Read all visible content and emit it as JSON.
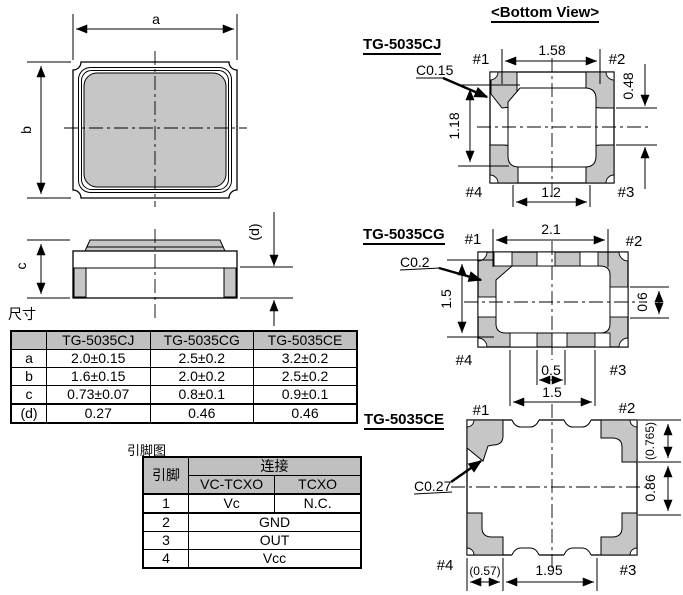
{
  "page": {
    "bottom_view_title": "<Bottom View>",
    "colors": {
      "line": "#000000",
      "pad_gray": "#c6c6c6",
      "table_header_bg": "#c0c0c0"
    }
  },
  "outline_view": {
    "dim_a": "a",
    "dim_b": "b",
    "dim_c": "c",
    "dim_d": "(d)"
  },
  "dimension_table": {
    "title": "尺寸",
    "columns": [
      "",
      "TG-5035CJ",
      "TG-5035CG",
      "TG-5035CE"
    ],
    "rows": [
      {
        "label": "a",
        "values": [
          "2.0±0.15",
          "2.5±0.2",
          "3.2±0.2"
        ]
      },
      {
        "label": "b",
        "values": [
          "1.6±0.15",
          "2.0±0.2",
          "2.5±0.2"
        ]
      },
      {
        "label": "c",
        "values": [
          "0.73±0.07",
          "0.8±0.1",
          "0.9±0.1"
        ]
      },
      {
        "label": "(d)",
        "values": [
          "0.27",
          "0.46",
          "0.46"
        ]
      }
    ]
  },
  "pin_table": {
    "title": "引脚图",
    "pin_header": "引脚",
    "connection_header": "连接",
    "sub_headers": [
      "VC-TCXO",
      "TCXO"
    ],
    "rows": [
      {
        "pin": "1",
        "vc_tcxo": "Vc",
        "tcxo": "N.C."
      },
      {
        "pin": "2",
        "shared": "GND"
      },
      {
        "pin": "3",
        "shared": "OUT"
      },
      {
        "pin": "4",
        "shared": "Vcc"
      }
    ]
  },
  "views": {
    "cj": {
      "label": "TG-5035CJ",
      "chamfer": "C0.15",
      "pin1": "#1",
      "pin2": "#2",
      "pin3": "#3",
      "pin4": "#4",
      "dim_top": "1.58",
      "dim_left": "1.18",
      "dim_right": "0.48",
      "dim_bottom": "1.2"
    },
    "cg": {
      "label": "TG-5035CG",
      "chamfer": "C0.2",
      "pin1": "#1",
      "pin2": "#2",
      "pin3": "#3",
      "pin4": "#4",
      "dim_top": "2.1",
      "dim_left": "1.5",
      "dim_right": "0.6",
      "dim_bottom_inner": "0.5",
      "dim_bottom": "1.5"
    },
    "ce": {
      "label": "TG-5035CE",
      "chamfer": "C0.27",
      "pin1": "#1",
      "pin2": "#2",
      "pin3": "#3",
      "pin4": "#4",
      "dim_right_top": "(0.765)",
      "dim_right": "0.86",
      "dim_bottom_left": "(0.57)",
      "dim_bottom": "1.95"
    }
  }
}
